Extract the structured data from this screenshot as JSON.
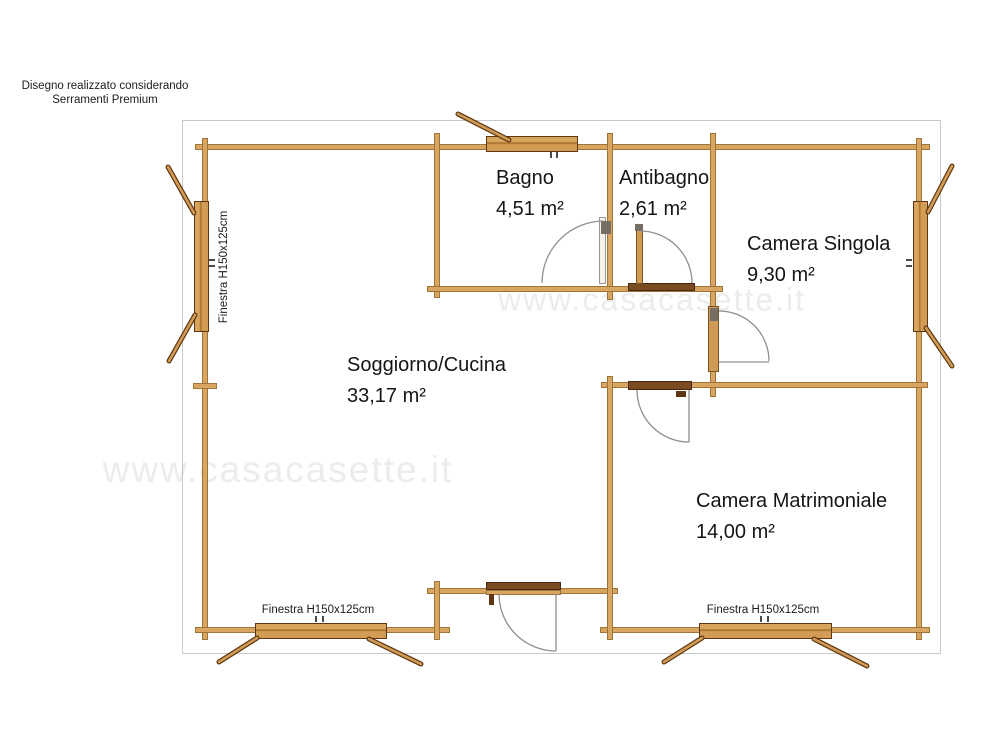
{
  "title_note": {
    "line1": "Disegno realizzato considerando",
    "line2": "Serramenti Premium"
  },
  "rooms": [
    {
      "name": "Bagno",
      "area": "4,51 m²"
    },
    {
      "name": "Antibagno",
      "area": "2,61 m²"
    },
    {
      "name": "Camera Singola",
      "area": "9,30 m²"
    },
    {
      "name": "Soggiorno/Cucina",
      "area": "33,17 m²"
    },
    {
      "name": "Camera Matrimoniale",
      "area": "14,00 m²"
    }
  ],
  "window_labels": {
    "left": "Finestra H150x125cm",
    "bottom_left": "Finestra H150x125cm",
    "bottom_right": "Finestra H150x125cm"
  },
  "watermarks": [
    {
      "text": "www.casacasette.it"
    },
    {
      "text": "www.casacasette.it"
    }
  ],
  "colors": {
    "wood": "#d8a660",
    "wood_border": "#9e7439",
    "window_wood": "#cf9a55",
    "window_border": "#5f3611",
    "dark_plank": "#7a4a20",
    "door_arc": "#8f8f8f",
    "text": "#151515",
    "watermark": "#ececeb",
    "frame": "#c9c9c9",
    "background": "#ffffff"
  }
}
